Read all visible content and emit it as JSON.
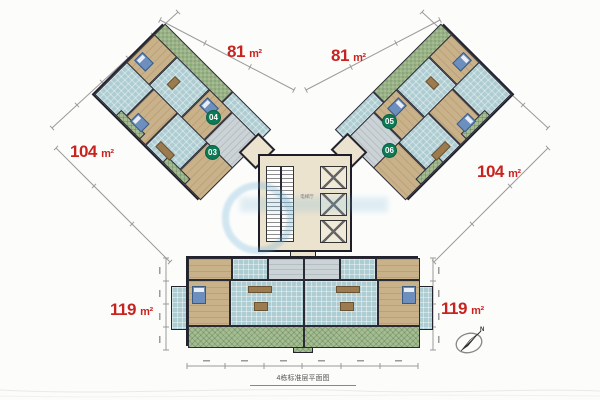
{
  "caption": "4栋标准层平面图",
  "area_labels": {
    "top_left": {
      "value": "81",
      "unit": "m²"
    },
    "top_right": {
      "value": "81",
      "unit": "m²"
    },
    "mid_left": {
      "value": "104",
      "unit": "m²"
    },
    "mid_right": {
      "value": "104",
      "unit": "m²"
    },
    "bottom_left": {
      "value": "119",
      "unit": "m²"
    },
    "bottom_right": {
      "value": "119",
      "unit": "m²"
    }
  },
  "unit_badges": {
    "u03": "03",
    "u04": "04",
    "u05": "05",
    "u06": "06"
  },
  "core": {
    "lobby_label": "电梯厅"
  },
  "compass": {
    "north_label": "N"
  },
  "colors": {
    "area_label_red": "#c9231f",
    "badge_green": "#0d7a55",
    "wall_dark": "#23232e",
    "floor_teal": "#aecdd2",
    "bedroom_tan": "#c9b189",
    "balcony_green": "#a6bd92",
    "core_cream": "#ece3cf",
    "bed_blue": "#6d8fbe",
    "watermark_blue": "#6eb4d7",
    "dimension_gray": "#9a9a9a"
  }
}
